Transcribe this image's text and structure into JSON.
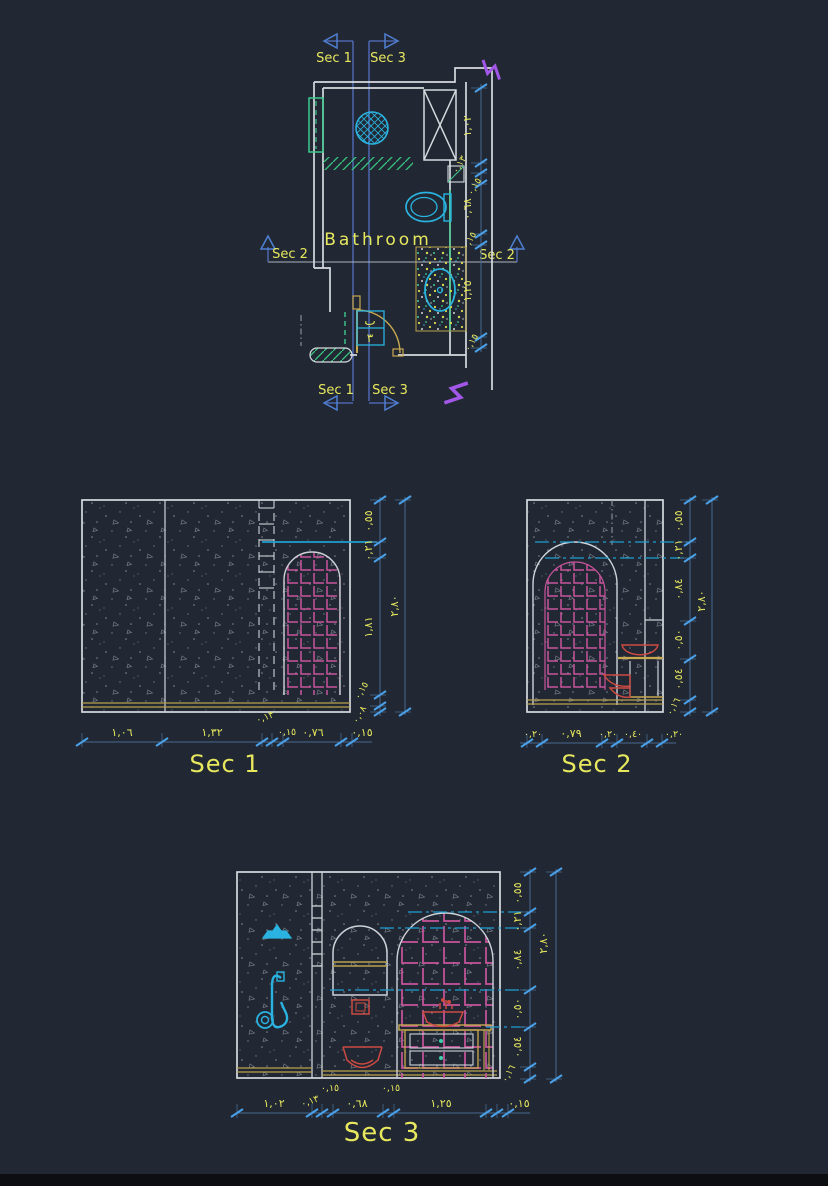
{
  "drawing": {
    "room_label": "Bathroom",
    "door_tag": {
      "top": "ب",
      "bottom": "٣"
    },
    "markers": {
      "sec1": "Sec 1",
      "sec2": "Sec 2",
      "sec3": "Sec 3"
    }
  },
  "plan": {
    "dims_right": [
      "١,٠٢",
      "٠,١٣",
      "٠,١٥",
      "٠,٦٨",
      "٠,١٥",
      "١,٢٥",
      "٠,١٥"
    ]
  },
  "sec1": {
    "title": "Sec 1",
    "dims_right": [
      "٠,٥٥",
      "٠,٢١",
      "١,٨١",
      "٠,١٥",
      "٠,٠٨"
    ],
    "dim_total": "٢,٨٠",
    "dims_bottom": [
      "١,٠٦",
      "١,٣٢",
      "٠,١٣",
      "٠,١٥",
      "٠,٧٦",
      "٠,١٥"
    ]
  },
  "sec2": {
    "title": "Sec 2",
    "dims_right": [
      "٠,٥٥",
      "٠,٢١",
      "٠,٨٤",
      "٠,٥٠",
      "٠,٥٤",
      "٠,١٦"
    ],
    "dim_total": "٢,٨٠",
    "dims_bottom": [
      "٠,٢٠",
      "٠,٧٩",
      "٠,٢٠",
      "٠,٤٠",
      "٠,٢٠"
    ]
  },
  "sec3": {
    "title": "Sec 3",
    "dims_right": [
      "٠,٥٥",
      "٠,٢١",
      "٠,٨٤",
      "٠,٥٠",
      "٠,٥٤",
      "٠,١٦"
    ],
    "dim_total": "٢,٨٠",
    "dims_bottom": [
      "١,٠٢",
      "٠,١٣",
      "٠,١٥",
      "٠,٦٨",
      "٠,١٥",
      "١,٢٥",
      "٠,١٥"
    ]
  },
  "colors": {
    "background": "#212833",
    "walls": "#d6dadf",
    "dimension_text": "#e8e85e",
    "dimension_line": "#46688f",
    "tick_blue": "#4aa0e8",
    "section_line": "#5570c4",
    "fixture_cyan": "#2ab3e0",
    "tile_magenta": "#c8549c",
    "joinery_yellow": "#c8a850",
    "sanitary_red": "#cd4a42",
    "green": "#3cc98c",
    "break_purple": "#a257e8"
  }
}
